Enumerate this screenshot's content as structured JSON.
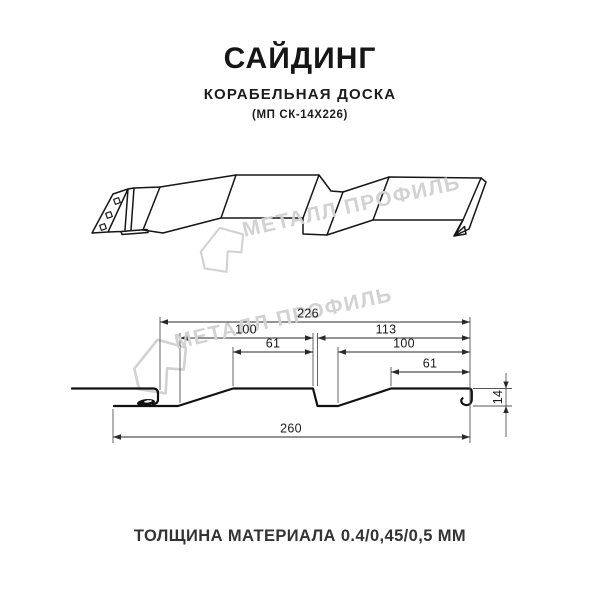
{
  "header": {
    "title": "САЙДИНГ",
    "subtitle": "КОРАБЕЛЬНАЯ ДОСКА",
    "code": "(МП СК-14Х226)"
  },
  "watermark": {
    "text": "МЕТАЛЛ ПРОФИЛЬ",
    "color": "#d2d2d2"
  },
  "drawing": {
    "line_color": "#161616",
    "dimension_color": "#2a2a2a"
  },
  "section": {
    "dims": {
      "total": "226",
      "pitch_left": "100",
      "pitch_right": "113",
      "flat_left": "61",
      "pitch_right_inner": "100",
      "flat_right": "61",
      "height": "14",
      "overall": "260"
    }
  },
  "footer": {
    "thickness": "ТОЛЩИНА МАТЕРИАЛА 0.4/0,45/0,5 ММ"
  }
}
